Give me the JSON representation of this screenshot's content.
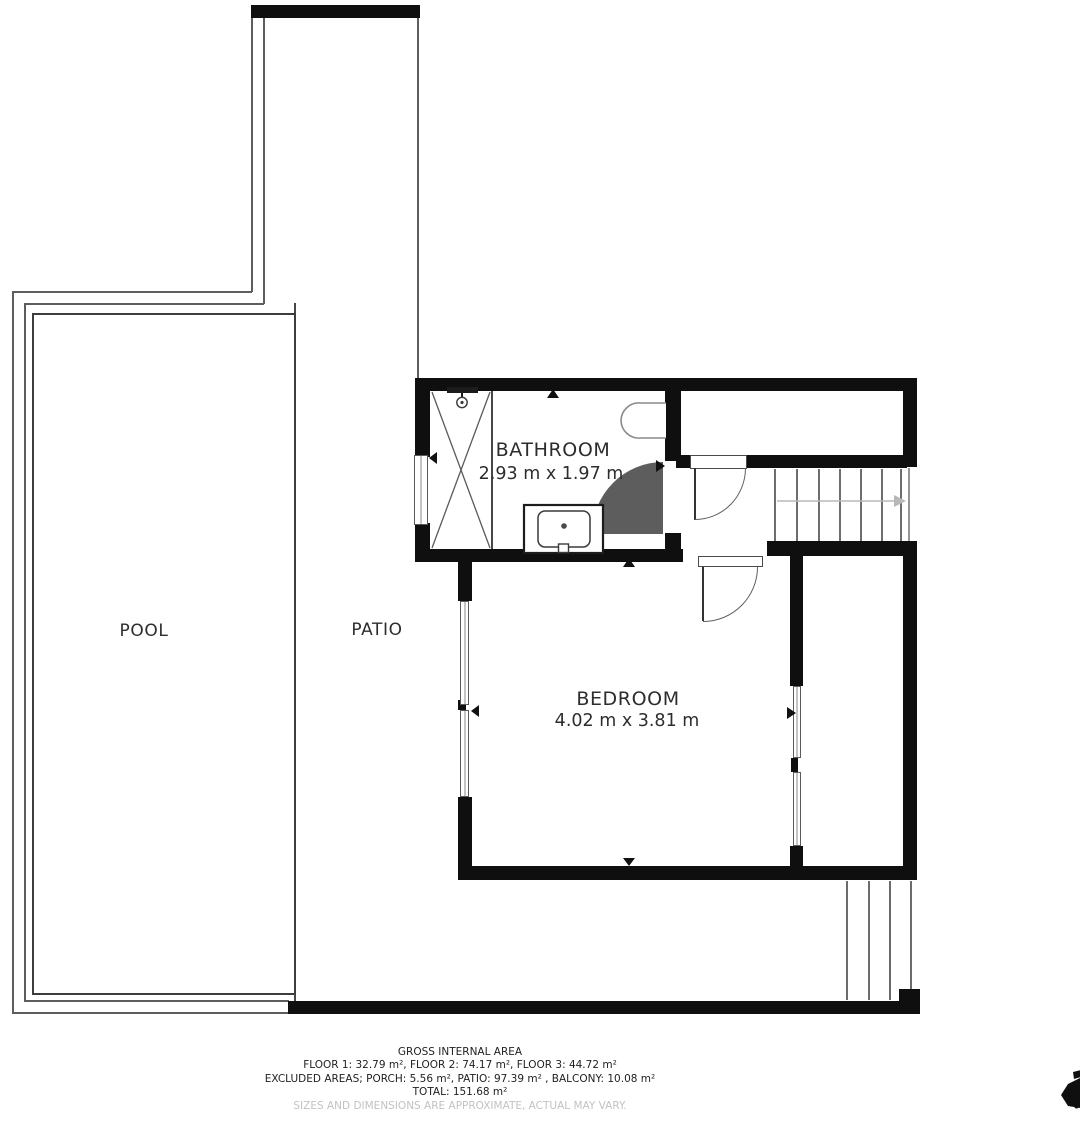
{
  "rooms": {
    "pool": {
      "label": "POOL"
    },
    "patio": {
      "label": "PATIO"
    },
    "bathroom": {
      "label": "BATHROOM",
      "dimensions": "2.93 m x 1.97 m"
    },
    "bedroom": {
      "label": "BEDROOM",
      "dimensions": "4.02 m x 3.81 m"
    }
  },
  "footer": {
    "title": "GROSS INTERNAL AREA",
    "line_floors": "FLOOR 1: 32.79 m², FLOOR 2: 74.17 m², FLOOR 3: 44.72 m²",
    "line_excluded": "EXCLUDED AREAS; PORCH: 5.56 m², PATIO: 97.39 m² , BALCONY: 10.08 m²",
    "line_total": "TOTAL: 151.68 m²",
    "disclaimer": "SIZES AND DIMENSIONS ARE APPROXIMATE, ACTUAL MAY VARY."
  },
  "fixtures": {
    "shower": "shower-enclosure-icon",
    "toilet": "toilet-icon",
    "sink": "sink-vanity-icon",
    "staircase": "staircase-with-direction-arrow",
    "exterior_steps": "exterior-steps"
  },
  "colors": {
    "wall": "#0f0f0f",
    "thin_line": "#5d5d5d",
    "pool_border": "#3d3d3d",
    "label_text": "#2d2d2d",
    "footer_text": "#1f1f1f",
    "disclaimer_text": "#c2c2c2",
    "stair_arrow": "#b8b8b8"
  }
}
